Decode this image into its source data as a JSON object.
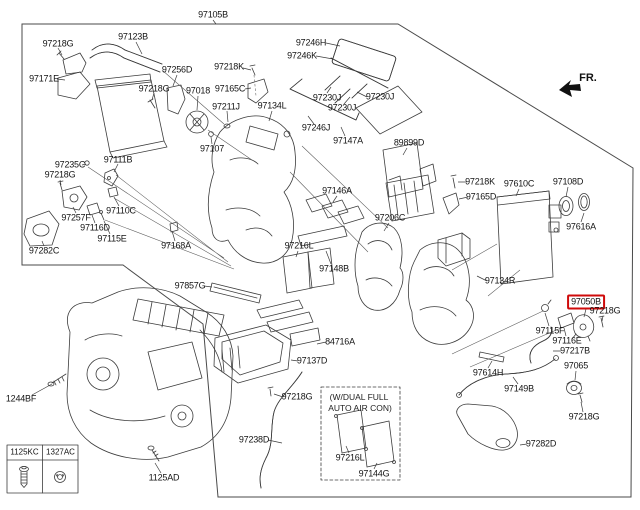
{
  "page": {
    "background": "#ffffff",
    "line_color": "#3c3c3c"
  },
  "fr_indicator": {
    "label": "FR."
  },
  "highlight": {
    "part": "97050B",
    "color": "#cf0a0a"
  },
  "conditional_note": {
    "line1": "(W/DUAL FULL",
    "line2": "AUTO AIR CON)"
  },
  "fastener_table": {
    "columns": [
      {
        "code": "1125KC",
        "icon": "bolt-icon"
      },
      {
        "code": "1327AC",
        "icon": "nut-icon"
      }
    ]
  },
  "part_labels": [
    {
      "text": "97105B",
      "x": 213,
      "y": 15
    },
    {
      "text": "97218G",
      "x": 58,
      "y": 44
    },
    {
      "text": "97123B",
      "x": 133,
      "y": 37
    },
    {
      "text": "97171E",
      "x": 44,
      "y": 79
    },
    {
      "text": "97256D",
      "x": 177,
      "y": 70
    },
    {
      "text": "97218G",
      "x": 154,
      "y": 89
    },
    {
      "text": "97018",
      "x": 198,
      "y": 91
    },
    {
      "text": "97218K",
      "x": 229,
      "y": 67
    },
    {
      "text": "97165C",
      "x": 230,
      "y": 89
    },
    {
      "text": "97211J",
      "x": 226,
      "y": 107
    },
    {
      "text": "97134L",
      "x": 272,
      "y": 106
    },
    {
      "text": "97107",
      "x": 212,
      "y": 149
    },
    {
      "text": "97246H",
      "x": 311,
      "y": 43
    },
    {
      "text": "97246K",
      "x": 302,
      "y": 56
    },
    {
      "text": "97230J",
      "x": 327,
      "y": 98
    },
    {
      "text": "97230J",
      "x": 380,
      "y": 97
    },
    {
      "text": "97230J",
      "x": 342,
      "y": 108
    },
    {
      "text": "97246J",
      "x": 316,
      "y": 128
    },
    {
      "text": "97147A",
      "x": 348,
      "y": 141
    },
    {
      "text": "89899D",
      "x": 409,
      "y": 143
    },
    {
      "text": "97235C",
      "x": 70,
      "y": 165
    },
    {
      "text": "97111B",
      "x": 118,
      "y": 160
    },
    {
      "text": "97218G",
      "x": 60,
      "y": 175
    },
    {
      "text": "97110C",
      "x": 121,
      "y": 211
    },
    {
      "text": "97257F",
      "x": 76,
      "y": 218
    },
    {
      "text": "97116D",
      "x": 95,
      "y": 228
    },
    {
      "text": "97115E",
      "x": 112,
      "y": 239
    },
    {
      "text": "97282C",
      "x": 44,
      "y": 251
    },
    {
      "text": "97168A",
      "x": 176,
      "y": 246
    },
    {
      "text": "97857G",
      "x": 190,
      "y": 286
    },
    {
      "text": "97146A",
      "x": 337,
      "y": 191
    },
    {
      "text": "97206C",
      "x": 390,
      "y": 218
    },
    {
      "text": "97216L",
      "x": 299,
      "y": 246
    },
    {
      "text": "97148B",
      "x": 334,
      "y": 269
    },
    {
      "text": "97218K",
      "x": 480,
      "y": 182
    },
    {
      "text": "97165D",
      "x": 481,
      "y": 197
    },
    {
      "text": "97610C",
      "x": 519,
      "y": 184
    },
    {
      "text": "97108D",
      "x": 568,
      "y": 182
    },
    {
      "text": "97616A",
      "x": 581,
      "y": 227
    },
    {
      "text": "97134R",
      "x": 500,
      "y": 281
    },
    {
      "text": "97050B",
      "x": 586,
      "y": 302,
      "highlight": true
    },
    {
      "text": "97218G",
      "x": 605,
      "y": 311
    },
    {
      "text": "97115F",
      "x": 550,
      "y": 331
    },
    {
      "text": "97116E",
      "x": 567,
      "y": 341
    },
    {
      "text": "97217B",
      "x": 575,
      "y": 351
    },
    {
      "text": "97065",
      "x": 576,
      "y": 366
    },
    {
      "text": "97614H",
      "x": 488,
      "y": 373
    },
    {
      "text": "97149B",
      "x": 519,
      "y": 389
    },
    {
      "text": "97218G",
      "x": 584,
      "y": 417
    },
    {
      "text": "97282D",
      "x": 541,
      "y": 444
    },
    {
      "text": "1244BF",
      "x": 21,
      "y": 399
    },
    {
      "text": "84716A",
      "x": 340,
      "y": 342
    },
    {
      "text": "97137D",
      "x": 312,
      "y": 361
    },
    {
      "text": "97218G",
      "x": 297,
      "y": 397
    },
    {
      "text": "97238D",
      "x": 254,
      "y": 440
    },
    {
      "text": "97216L",
      "x": 350,
      "y": 458
    },
    {
      "text": "97144G",
      "x": 374,
      "y": 474
    },
    {
      "text": "1125AD",
      "x": 164,
      "y": 478
    }
  ]
}
